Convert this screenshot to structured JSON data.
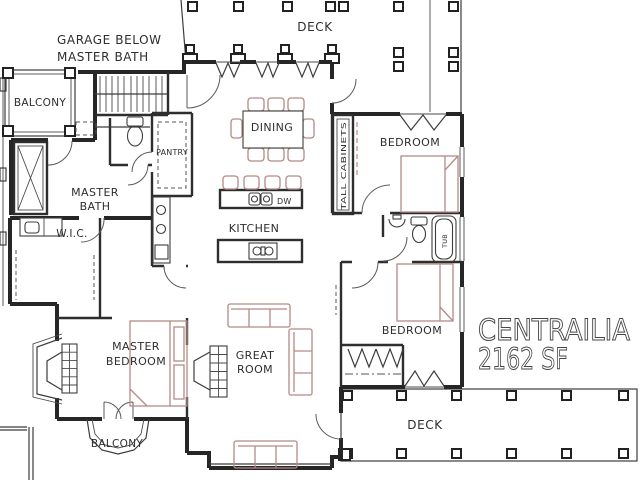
{
  "title": {
    "name": "CENTRAILIA",
    "area": "2162 SF"
  },
  "annotations": {
    "garage_note_line1": "GARAGE BELOW",
    "garage_note_line2": "MASTER BATH"
  },
  "rooms": {
    "deck_top": "DECK",
    "deck_bottom": "DECK",
    "balcony_upper": "BALCONY",
    "balcony_lower": "BALCONY",
    "master_bath_line1": "MASTER",
    "master_bath_line2": "BATH",
    "master_bedroom_line1": "MASTER",
    "master_bedroom_line2": "BEDROOM",
    "great_room_line1": "GREAT",
    "great_room_line2": "ROOM",
    "dining": "DINING",
    "kitchen": "KITCHEN",
    "pantry": "PANTRY",
    "wic": "W.I.C.",
    "bedroom_upper": "BEDROOM",
    "bedroom_lower": "BEDROOM"
  },
  "fixtures": {
    "dishwasher": "DW",
    "tall_cabinets": "TALL CABINETS",
    "tub": "TUB"
  },
  "colors": {
    "walls": "#262626",
    "furniture": "#b58a85",
    "text": "#2e2e2e",
    "background": "#ffffff"
  }
}
